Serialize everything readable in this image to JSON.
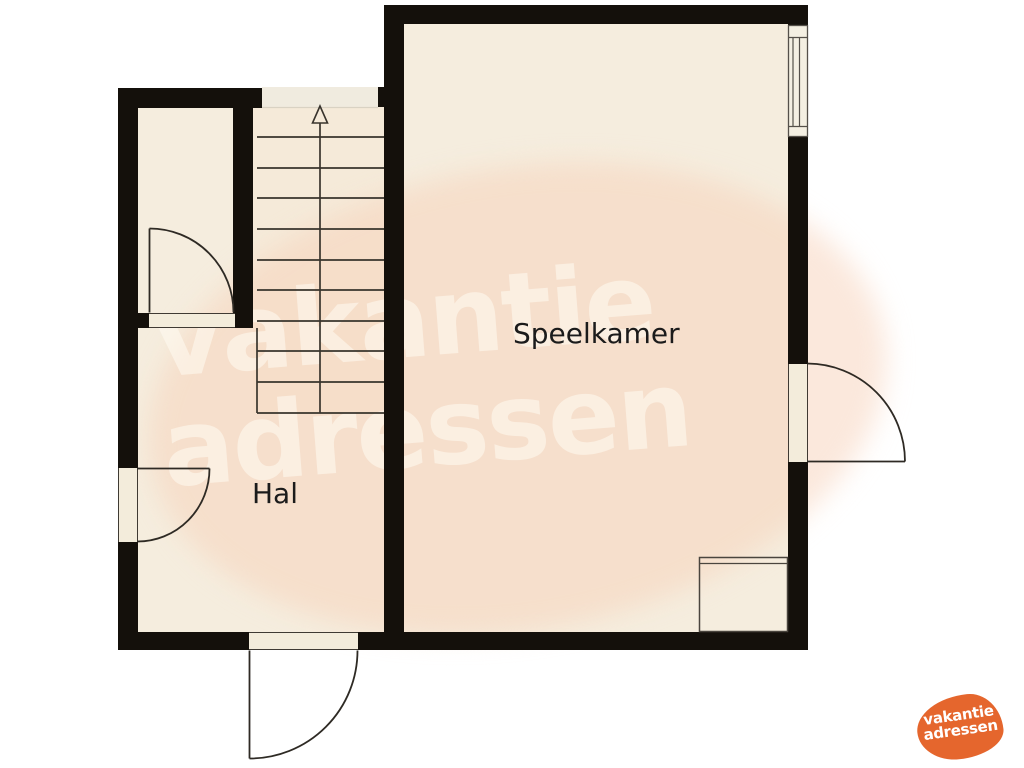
{
  "floorplan": {
    "rooms": [
      {
        "id": "speelkamer",
        "label": "Speelkamer"
      },
      {
        "id": "hal",
        "label": "Hal"
      }
    ],
    "stairs": {
      "direction": "up",
      "tread_count": 10
    },
    "doors": [
      {
        "id": "closet-door",
        "wall": "closet-bottom",
        "swing": "inward"
      },
      {
        "id": "hall-west-door",
        "wall": "left",
        "swing": "inward"
      },
      {
        "id": "front-door",
        "wall": "bottom",
        "swing": "outward"
      },
      {
        "id": "speelkamer-east-door",
        "wall": "right",
        "swing": "outward"
      }
    ],
    "window_count": 1,
    "colors": {
      "wall": "#14100b",
      "floor": "#f5edde",
      "stair_floor": "#f5ead9",
      "landing": "#f0ebdf",
      "line": "#2e2a24",
      "watermark_pink": "rgba(248,210,186,0.5)",
      "logo_orange": "#e5662d"
    }
  },
  "watermark": {
    "line1": "vakantie",
    "line2": "adressen"
  },
  "logo": {
    "line1": "vakantie",
    "line2": "adressen"
  }
}
